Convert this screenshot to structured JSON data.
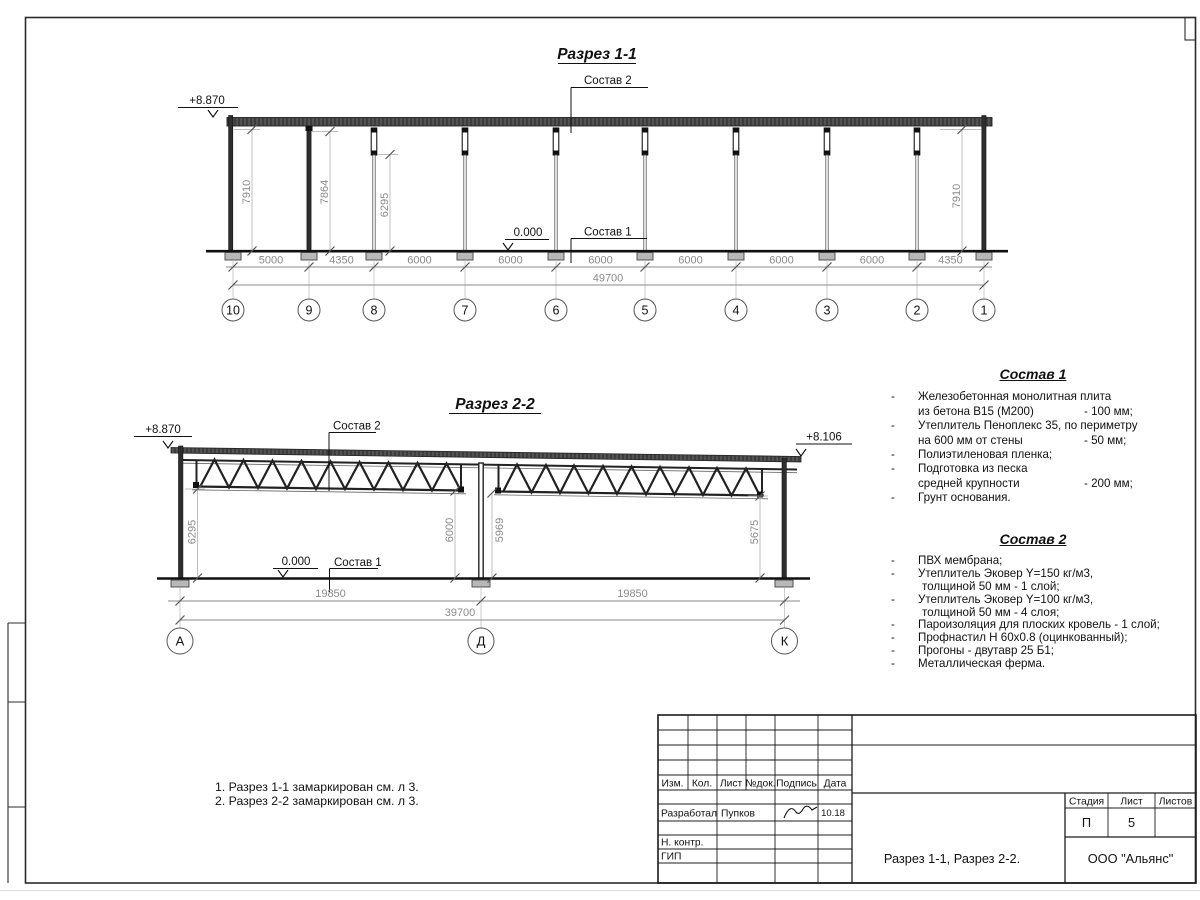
{
  "section1": {
    "title": "Разрез 1-1",
    "elev_left": "+8.870",
    "zero": "0.000",
    "label_sostav1": "Состав 1",
    "label_sostav2": "Состав 2",
    "dim_v": [
      "7910",
      "7864",
      "6295",
      "7910"
    ],
    "dims": [
      "5000",
      "4350",
      "6000",
      "6000",
      "6000",
      "6000",
      "6000",
      "6000",
      "4350"
    ],
    "total": "49700",
    "axes": [
      "10",
      "9",
      "8",
      "7",
      "6",
      "5",
      "4",
      "3",
      "2",
      "1"
    ]
  },
  "section2": {
    "title": "Разрез 2-2",
    "elev_left": "+8.870",
    "elev_right": "+8.106",
    "zero": "0.000",
    "label_sostav1": "Состав 1",
    "label_sostav2": "Состав 2",
    "dim_v": [
      "6295",
      "6000",
      "5969",
      "5675"
    ],
    "dims": [
      "19850",
      "19850"
    ],
    "total": "39700",
    "axes": [
      "А",
      "Д",
      "К"
    ]
  },
  "sostav1": {
    "title": "Состав 1",
    "items": [
      {
        "b": "-",
        "l1": "Железобетонная  монолитная плита",
        "l2": "из бетона В15 (М200)",
        "v": "- 100 мм;"
      },
      {
        "b": "-",
        "l1": "Утеплитель Пеноплекс 35, по периметру",
        "l2": "на 600 мм от стены",
        "v": "- 50 мм;"
      },
      {
        "b": "-",
        "l1": "Полиэтиленовая пленка;"
      },
      {
        "b": "-",
        "l1": "Подготовка из песка",
        "l2": "средней крупности",
        "v": "- 200 мм;"
      },
      {
        "b": "-",
        "l1": "Грунт основания."
      }
    ]
  },
  "sostav2": {
    "title": "Состав 2",
    "items": [
      {
        "b": "-",
        "l1": "ПВХ мембрана;"
      },
      {
        "b": "-",
        "l1": "Утеплитель Эковер Y=150 кг/м3,",
        "l2": "толщиной 50 мм - 1 слой;"
      },
      {
        "b": "-",
        "l1": "Утеплитель Эковер Y=100 кг/м3,",
        "l2": "толщиной 50 мм - 4 слоя;"
      },
      {
        "b": "-",
        "l1": "Пароизоляция для плоских кровель - 1 слой;"
      },
      {
        "b": "-",
        "l1": "Профнастил Н 60х0.8 (оцинкованный);"
      },
      {
        "b": "-",
        "l1": "Прогоны - двутавр 25 Б1;"
      },
      {
        "b": "-",
        "l1": "Металлическая ферма."
      }
    ]
  },
  "notes": {
    "line1": "1. Разрез 1-1 замаркирован см. л 3.",
    "line2": "2. Разрез 2-2 замаркирован см. л 3."
  },
  "titleblock": {
    "cols": [
      "Изм.",
      "Кол.",
      "Лист",
      "№док.",
      "Подпись",
      "Дата"
    ],
    "dev_role": "Разработал",
    "dev_name": "Пупков",
    "dev_date": "10.18",
    "nk_role": "Н. контр.",
    "gip_role": "ГИП",
    "doc_title": "Разрез 1-1, Разрез 2-2.",
    "stage_h": "Стадия",
    "sheet_h": "Лист",
    "sheets_h": "Листов",
    "stage": "П",
    "sheet_no": "5",
    "company": "ООО \"Альянс\""
  },
  "colors": {
    "line_dark": "#1c1c1c",
    "dim_gray": "#8b8b8b",
    "hatch_dark": "#3d3d3d"
  }
}
